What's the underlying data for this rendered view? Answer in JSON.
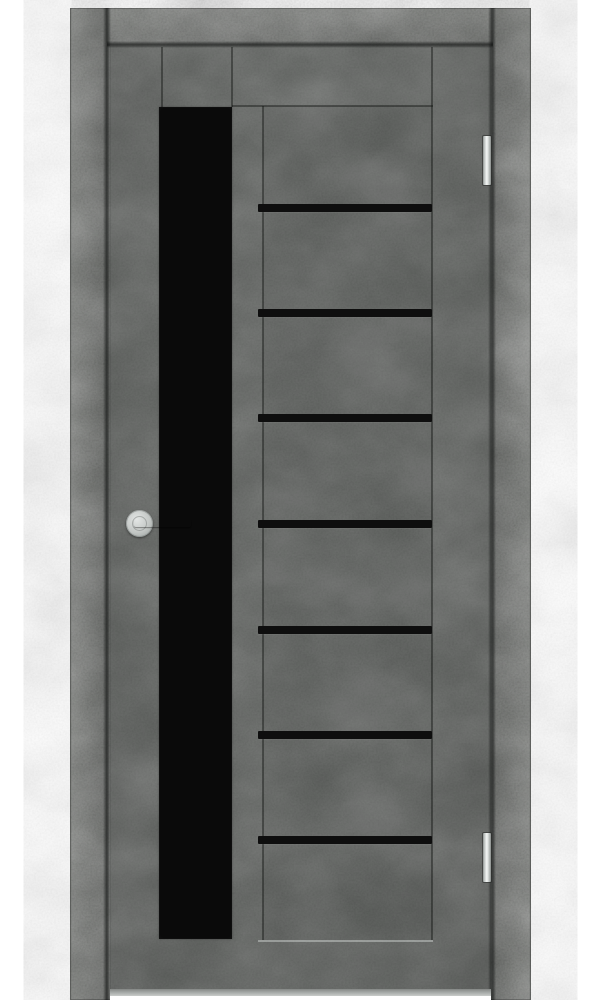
{
  "scene": {
    "type": "product photo",
    "subject": "Interior door in dark grey loft-concrete finish with black glass inserts, closed, front view",
    "background_color": "#ffffff"
  },
  "door": {
    "orientation": "handle on left side, hinges on right side",
    "frame": {
      "name": "frame casing",
      "color": "#5d605c"
    },
    "slab": {
      "name": "door slab",
      "color": "#555855"
    },
    "glass_vertical": {
      "name": "full-height vertical black glass insert",
      "color": "#0a0a0a"
    },
    "glass_strips": {
      "name": "horizontal black glass strips",
      "count": 7,
      "color": "#0e0e0e",
      "y_positions": [
        204,
        309,
        414,
        520,
        626,
        731,
        836
      ]
    },
    "handle": {
      "name": "round-rosette lever handle",
      "finish": "matte chrome",
      "color": "#c2c6c4"
    },
    "hinges": {
      "name": "pin hinges",
      "count": 2,
      "color": "#e9ebea",
      "y_positions": [
        136,
        833
      ]
    }
  }
}
